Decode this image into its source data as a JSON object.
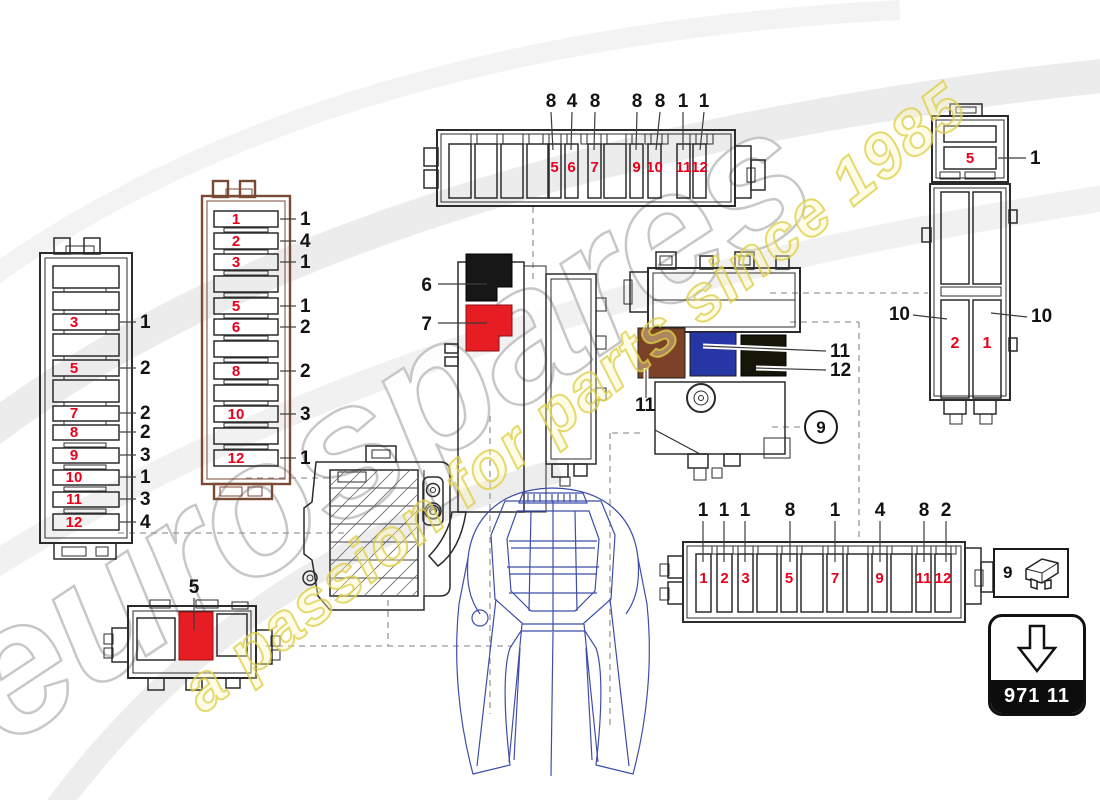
{
  "watermark": {
    "brand": "eurospares",
    "tagline": "a passion for parts since 1985"
  },
  "legend": {
    "number": "9"
  },
  "part_box": {
    "code": "971 11"
  },
  "diagram": {
    "top_strip": {
      "fuses": [
        "5",
        "6",
        "7",
        "9",
        "10",
        "11",
        "12"
      ],
      "callouts": [
        "8",
        "4",
        "8",
        "8",
        "8",
        "1",
        "1"
      ]
    },
    "bottom_strip": {
      "fuses": [
        "1",
        "2",
        "3",
        "5",
        "7",
        "9",
        "11",
        "12"
      ],
      "callouts": [
        "1",
        "1",
        "1",
        "8",
        "1",
        "4",
        "8",
        "2"
      ]
    },
    "left_box": {
      "fuses": [
        "3",
        "5",
        "7",
        "8",
        "9",
        "10",
        "11",
        "12"
      ],
      "callouts": [
        "1",
        "2",
        "2",
        "2",
        "3",
        "1",
        "3",
        "4"
      ]
    },
    "left_box2": {
      "fuses": [
        "1",
        "2",
        "3",
        "5",
        "6",
        "8",
        "10",
        "12"
      ],
      "callouts": [
        "1",
        "4",
        "1",
        "1",
        "2",
        "2",
        "3",
        "1"
      ]
    },
    "right_box": {
      "fuses": [
        "5",
        "2",
        "1"
      ],
      "callouts": [
        "1",
        "10",
        "10"
      ]
    },
    "bracket": {
      "callouts": [
        "6",
        "7"
      ]
    },
    "relay": {
      "callouts": [
        "11",
        "12",
        "11"
      ],
      "circle": "9"
    },
    "small_box": {
      "callout": "5"
    }
  },
  "colors": {
    "fuse_number_red": "#e8001c",
    "connector_red": "#e61e24",
    "connector_black": "#171717",
    "connector_brown": "#7b4227",
    "connector_blue": "#2636a4",
    "connector_dark": "#15150a",
    "housing_brown": "#7a4a35",
    "car_blue": "#3e4ea8",
    "watermark_yellow": "#decd46",
    "watermark_gray": "#c7c7c7"
  }
}
